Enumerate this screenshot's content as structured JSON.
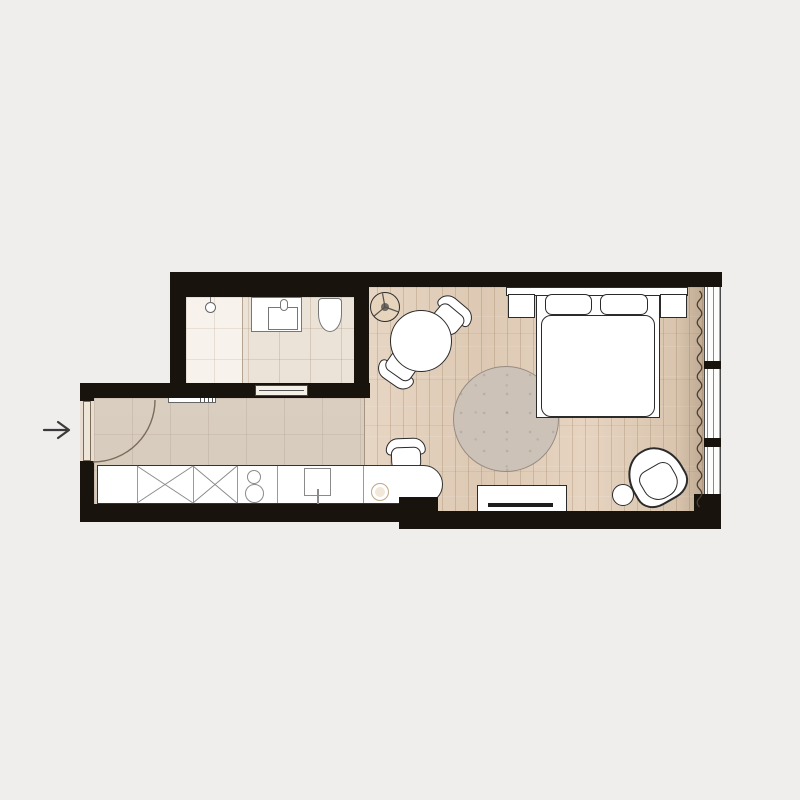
{
  "plan": {
    "background_color": "#efeeec",
    "wall_color": "#18130d",
    "furniture_outline_color": "#2b2b2b",
    "furniture_fill_color": "#ffffff",
    "entrance": {
      "symbol": "arrow-right-icon"
    },
    "rooms": {
      "bathroom": {
        "floor_color": "#ece3d8",
        "shower_floor_color": "#f7f2ec",
        "items": [
          "shower-area",
          "shower-head",
          "vanity-cabinet",
          "washbasin",
          "faucet",
          "toilet",
          "sliding-door"
        ]
      },
      "hallway_kitchen": {
        "floor_color": "#d6cabc",
        "counter_color": "#ffffff",
        "items": [
          "entry-door",
          "door-swing-arc",
          "entry-shelf",
          "kitchen-counter",
          "tall-cabinet",
          "tall-cabinet",
          "cooktop-two-burners",
          "kitchen-sink",
          "sink-faucet",
          "counter-bowl",
          "desk-chair"
        ]
      },
      "living_bedroom": {
        "floor_color": "#e3d1bd",
        "rug_color": "#ccc2b8",
        "items": [
          "decor-side-table",
          "round-dining-table",
          "dining-chair",
          "dining-chair",
          "round-rug",
          "bed-headboard",
          "nightstand-left",
          "nightstand-right",
          "pillow",
          "pillow",
          "bed-duvet",
          "tv-console",
          "tv",
          "pouf",
          "armchair",
          "curtain-wave",
          "window-wall",
          "window-mullion",
          "window-mullion"
        ]
      }
    }
  }
}
